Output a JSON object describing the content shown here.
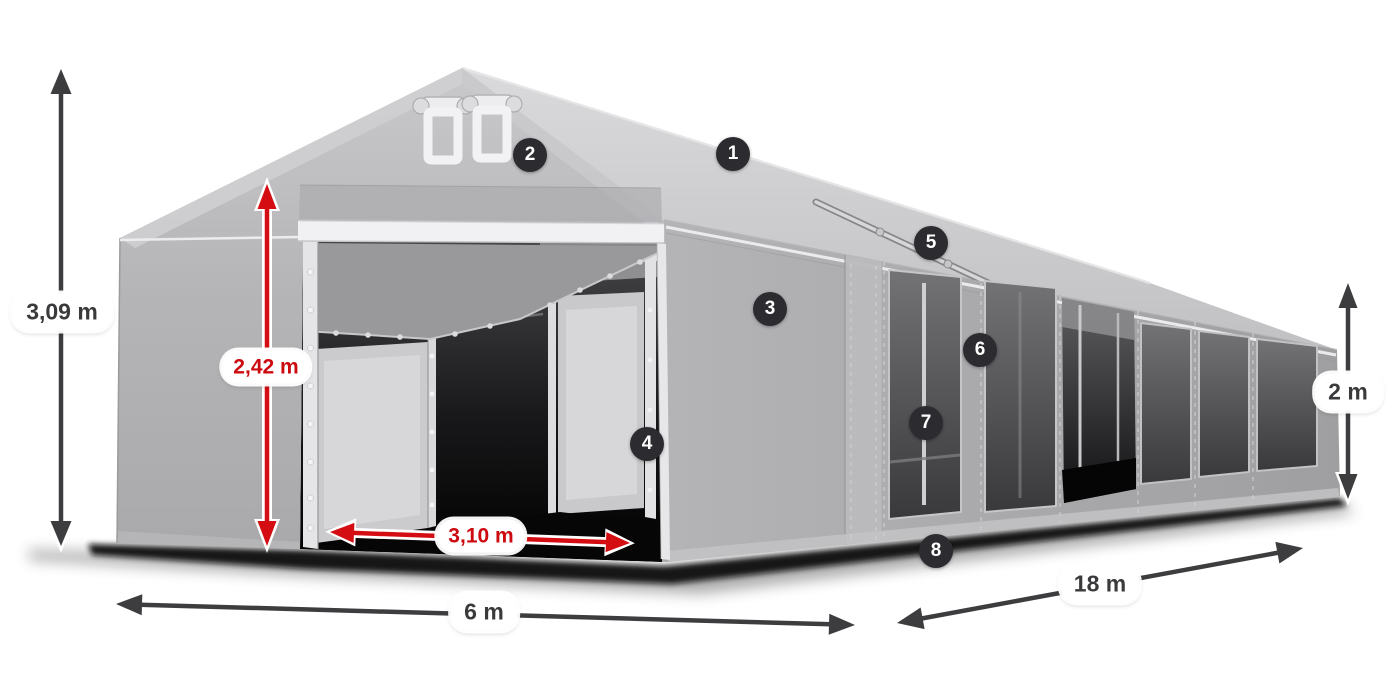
{
  "title": "Tent 6x18 m dimension diagram",
  "canvas": {
    "width": 1400,
    "height": 700,
    "background": "#ffffff"
  },
  "colors": {
    "arrow_dark": "#3d3d3f",
    "arrow_red": "#d40d12",
    "label_text_dark": "#3a3a3c",
    "label_text_red": "#cc0a10",
    "badge_background": "#2b2b30",
    "badge_text": "#ffffff",
    "tent_roof": "#cccccf",
    "tent_wall": "#aeaeb0",
    "tent_window": "#4a4a4d"
  },
  "dimension_labels": [
    {
      "id": "total-height",
      "text": "3,09 m",
      "style": "dark",
      "x": 62,
      "y": 312
    },
    {
      "id": "entrance-height",
      "text": "2,42 m",
      "style": "red",
      "x": 266,
      "y": 367
    },
    {
      "id": "entrance-width",
      "text": "3,10 m",
      "style": "red",
      "x": 481,
      "y": 536
    },
    {
      "id": "tent-width",
      "text": "6 m",
      "style": "dark",
      "x": 484,
      "y": 612
    },
    {
      "id": "tent-length",
      "text": "18 m",
      "style": "dark",
      "x": 1100,
      "y": 584
    },
    {
      "id": "side-height",
      "text": "2 m",
      "style": "dark",
      "x": 1348,
      "y": 392
    }
  ],
  "part_callouts": [
    {
      "number": "1",
      "x": 733,
      "y": 154
    },
    {
      "number": "2",
      "x": 530,
      "y": 155
    },
    {
      "number": "3",
      "x": 770,
      "y": 309
    },
    {
      "number": "4",
      "x": 647,
      "y": 444
    },
    {
      "number": "5",
      "x": 931,
      "y": 243
    },
    {
      "number": "6",
      "x": 980,
      "y": 350
    },
    {
      "number": "7",
      "x": 926,
      "y": 423
    },
    {
      "number": "8",
      "x": 936,
      "y": 551
    }
  ]
}
